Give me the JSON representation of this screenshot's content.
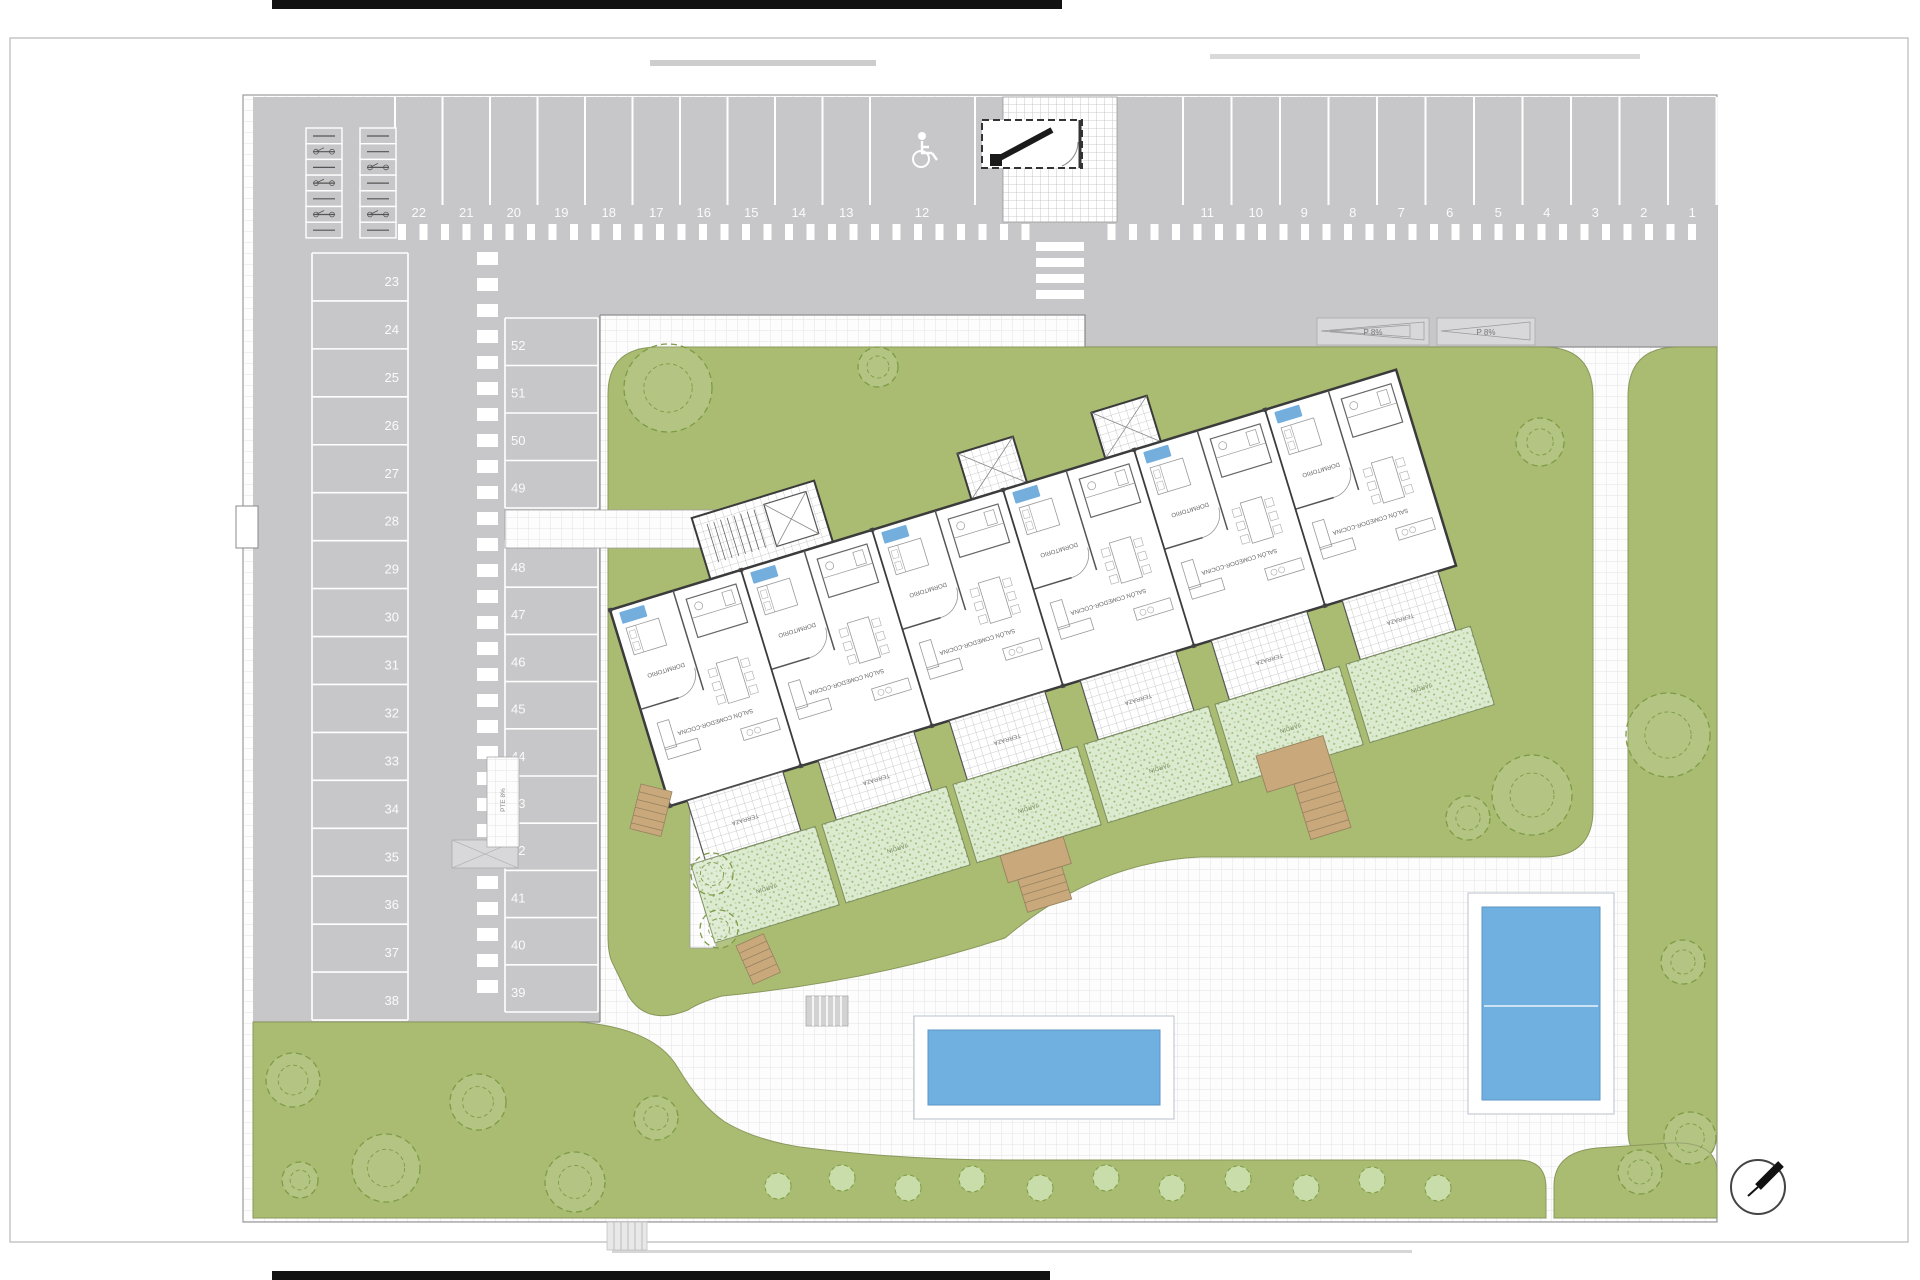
{
  "plan": {
    "parking_numbers": {
      "top_left_to_right": [
        "22",
        "21",
        "20",
        "19",
        "18",
        "17",
        "16",
        "15",
        "14",
        "13"
      ],
      "accessible_space": "12",
      "top_right_section": [
        "11",
        "10",
        "9",
        "8",
        "7",
        "6",
        "5",
        "4",
        "3",
        "2",
        "1"
      ],
      "left_column_top_to_bottom": [
        "23",
        "24",
        "25",
        "26",
        "27",
        "28",
        "29",
        "30",
        "31",
        "32",
        "33",
        "34",
        "35",
        "36",
        "37",
        "38"
      ],
      "middle_column_top_to_bottom": [
        "52",
        "51",
        "50",
        "49",
        "48",
        "47",
        "46",
        "45",
        "44",
        "43",
        "42",
        "41",
        "40",
        "39"
      ]
    },
    "ramps": {
      "p8": "P 8%",
      "pte8": "PTE 8%"
    },
    "building_labels": {
      "bedroom": "DORMITORIO",
      "living": "SALÓN COMEDOR-COCINA",
      "terrace": "TERRAZA",
      "garden": "JARDÍN"
    },
    "colors": {
      "parking_gray": "#c7c7c9",
      "lawn_green": "#a9bc72",
      "private_garden_green": "#dcead0",
      "pool_blue": "#6fb0e0",
      "wood_tan": "#c9a87c"
    },
    "icons": {
      "accessible_parking": "wheelchair-icon",
      "north": "north-arrow-icon",
      "bike_parking": "bike-rack-icon",
      "vegetation": "tree-icon"
    }
  }
}
